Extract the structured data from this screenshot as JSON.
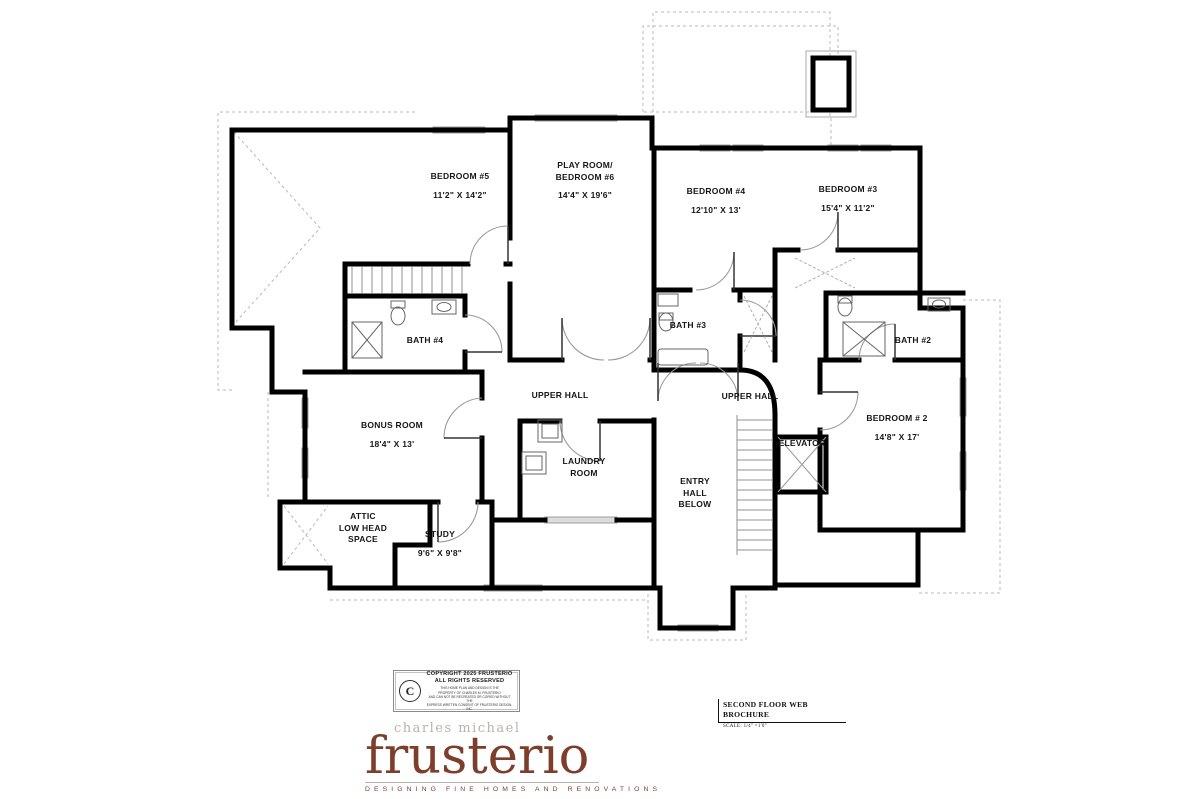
{
  "plan": {
    "rooms": [
      {
        "lines": [
          "BEDROOM #5"
        ],
        "dims": "11'2\" X 14'2\""
      },
      {
        "lines": [
          "PLAY ROOM/",
          "BEDROOM #6"
        ],
        "dims": "14'4\" X 19'6\""
      },
      {
        "lines": [
          "BEDROOM #4"
        ],
        "dims": "12'10\" X 13'"
      },
      {
        "lines": [
          "BEDROOM #3"
        ],
        "dims": "15'4\" X 11'2\""
      },
      {
        "lines": [
          "BATH #4"
        ],
        "dims": ""
      },
      {
        "lines": [
          "BATH #3"
        ],
        "dims": ""
      },
      {
        "lines": [
          "BATH #2"
        ],
        "dims": ""
      },
      {
        "lines": [
          "UPPER HALL"
        ],
        "dims": ""
      },
      {
        "lines": [
          "UPPER HALL"
        ],
        "dims": ""
      },
      {
        "lines": [
          "BONUS ROOM"
        ],
        "dims": "18'4\" X 13'"
      },
      {
        "lines": [
          "ATTIC",
          "LOW HEAD",
          "SPACE"
        ],
        "dims": ""
      },
      {
        "lines": [
          "STUDY"
        ],
        "dims": "9'6\" X 9'8\""
      },
      {
        "lines": [
          "LAUNDRY",
          "ROOM"
        ],
        "dims": ""
      },
      {
        "lines": [
          "ENTRY",
          "HALL",
          "BELOW"
        ],
        "dims": ""
      },
      {
        "lines": [
          "ELEVATOR"
        ],
        "dims": ""
      },
      {
        "lines": [
          "BEDROOM # 2"
        ],
        "dims": "14'8\" X 17'"
      }
    ]
  },
  "copyright": {
    "symbol": "C",
    "line1": "COPYRIGHT 2025 FRUSTERIO",
    "line2": "ALL RIGHTS RESERVED",
    "fine1": "THIS HOME PLAN AND DESIGN IS THE",
    "fine2": "PROPERTY OF CHARLES M. FRUSTERIO",
    "fine3": "AND CAN NOT BE RECREATED OR COPIED WITHOUT THE",
    "fine4": "EXPRESS WRITTEN CONSENT OF FRUSTERIO DESIGN, INC."
  },
  "title_block": {
    "title": "SECOND FLOOR WEB BROCHURE",
    "scale": "SCALE:  1/4\" =1'0\""
  },
  "logo": {
    "top": "charles michael",
    "main": "frusterio",
    "tagline": "DESIGNING FINE HOMES AND RENOVATIONS",
    "brand_color": "#7d3e2c",
    "gray_color": "#b7b3ae"
  }
}
